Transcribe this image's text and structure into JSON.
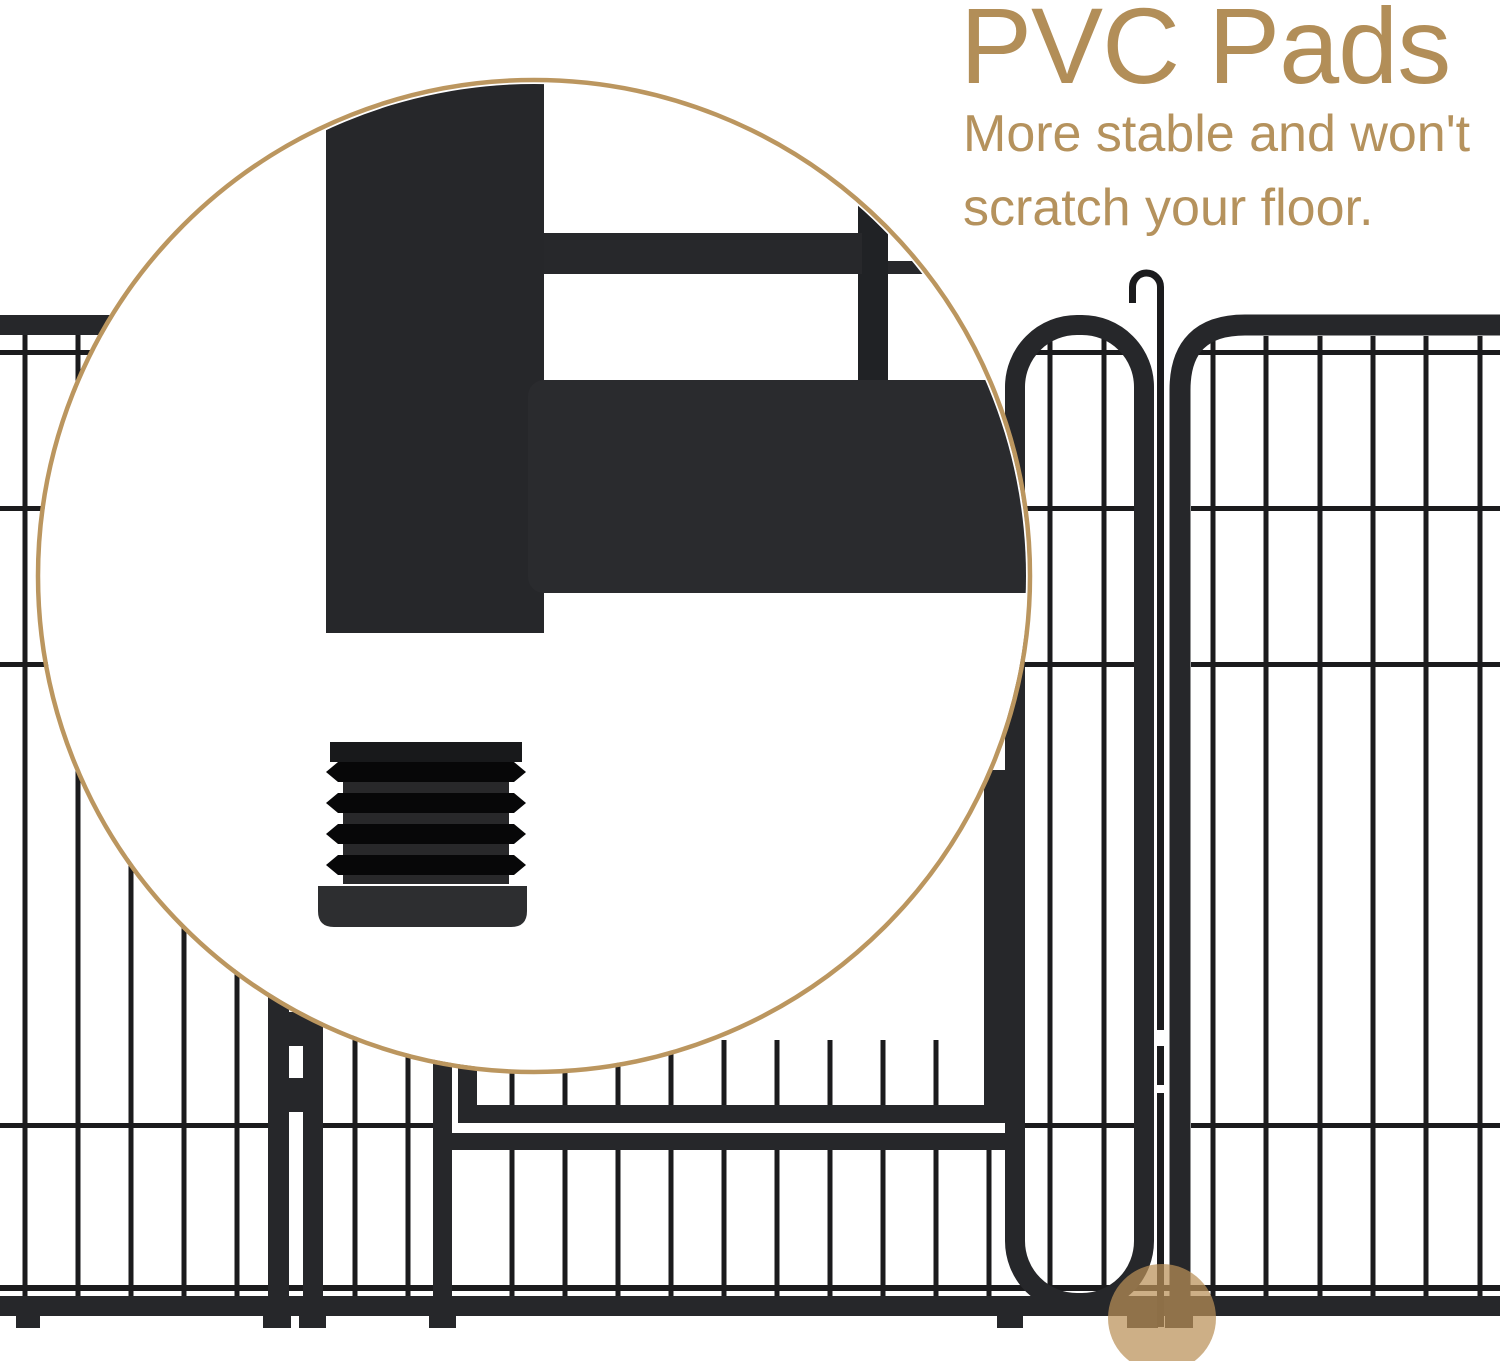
{
  "heading": {
    "title": "PVC Pads",
    "subtitle_lines": [
      "More stable and won't",
      "scratch your floor."
    ]
  },
  "colors": {
    "tan": "#bb965f",
    "tan-text": "#b28e58",
    "tan-text-light": "#b5925d",
    "wire": "#1b1b1d",
    "frame": "#26272a",
    "dot": "#ba9057",
    "bg": "#ffffff"
  }
}
